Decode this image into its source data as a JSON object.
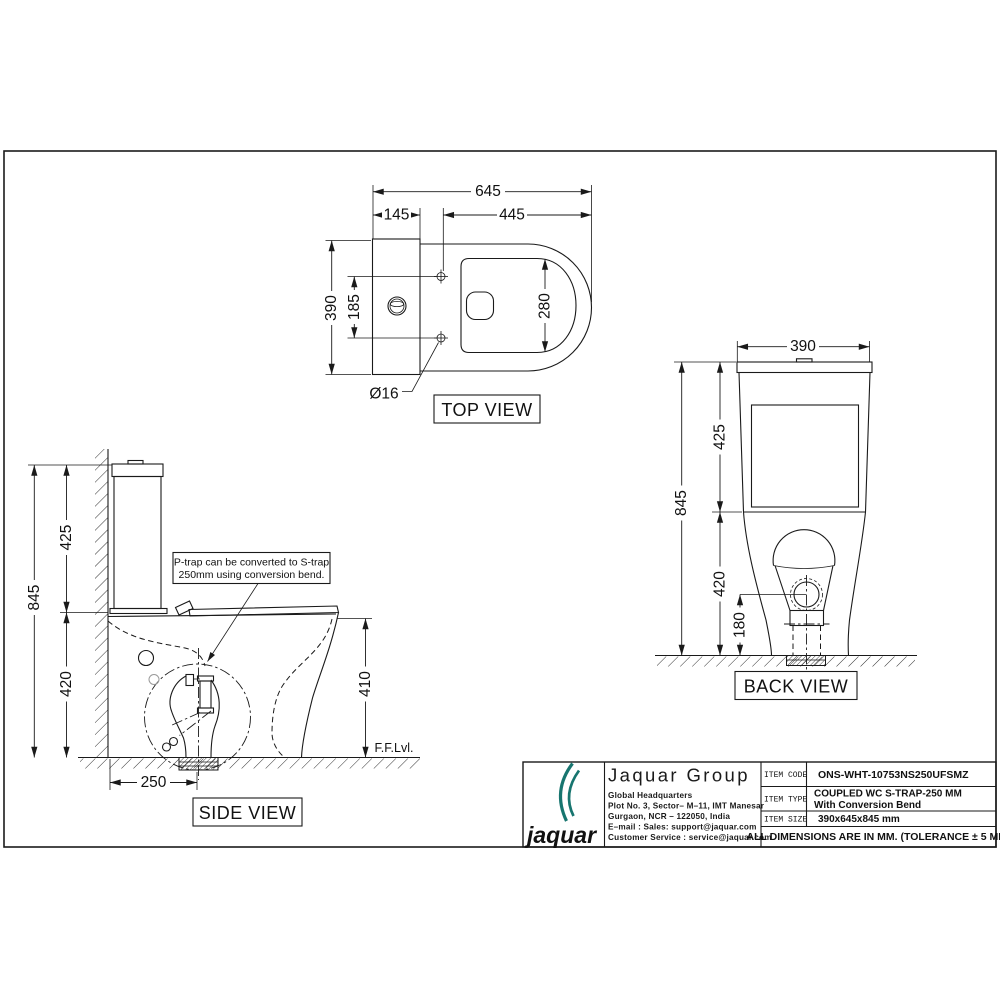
{
  "page": {
    "background": "#ffffff",
    "line_color": "#1a1a1a"
  },
  "drawing": {
    "top_view": {
      "title": "TOP VIEW",
      "dim_overall_width": "645",
      "dim_tank_depth": "145",
      "dim_bowl_length": "445",
      "dim_overall_depth": "390",
      "dim_hinge_span": "185",
      "dim_seat_width": "280",
      "dim_hinge_hole": "Ø16"
    },
    "side_view": {
      "title": "SIDE VIEW",
      "dim_total_height": "845",
      "dim_tank_height": "425",
      "dim_bowl_height": "420",
      "dim_rim_height": "410",
      "dim_trap_distance": "250",
      "floor_level_label": "F.F.Lvl.",
      "note_line1": "P-trap can be converted to S-trap",
      "note_line2": "250mm using conversion bend."
    },
    "back_view": {
      "title": "BACK VIEW",
      "dim_width": "390",
      "dim_total_height": "845",
      "dim_tank_height": "425",
      "dim_lower_height": "420",
      "dim_outlet_height": "180"
    }
  },
  "title_block": {
    "logo_text": "jaquar",
    "brand_color": "#17756f",
    "company": "Jaquar Group",
    "address_line1": "Global Headquarters",
    "address_line2": "Plot No. 3, Sector– M–11, IMT Manesar",
    "address_line3": "Gurgaon, NCR – 122050, India",
    "address_line4": "E–mail : Sales: support@jaquar.com",
    "address_line5": "Customer Service : service@jaquar.com",
    "item_code_label": "ITEM CODE",
    "item_code": "ONS-WHT-10753NS250UFSMZ",
    "item_type_label": "ITEM TYPE",
    "item_type_line1": "COUPLED WC S-TRAP-250 MM",
    "item_type_line2": "With Conversion Bend",
    "item_size_label": "ITEM SIZE",
    "item_size": "390x645x845  mm",
    "tolerance_note": "ALL DIMENSIONS ARE IN MM. (TOLERANCE ± 5 MM)"
  }
}
